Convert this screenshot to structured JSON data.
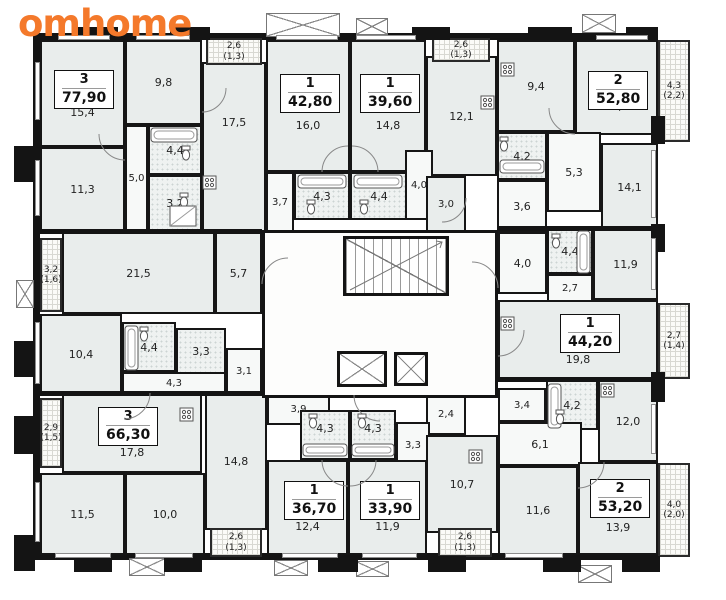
{
  "logo": {
    "text": "omhome",
    "color": "#f4792b"
  },
  "colors": {
    "wall": "#141414",
    "room_fill": "#e9edec",
    "bath_fill": "#eff2f1"
  },
  "apartments": [
    {
      "rooms_count": "3",
      "total_area": "77,90",
      "rooms": {
        "bedroom_1": "15,4",
        "bedroom_2": "11,3",
        "bedroom_3": "9,8",
        "living": "21,5",
        "kitchen": "5,7",
        "hall": "5,0",
        "bathroom": "4,4",
        "wc": "3,2"
      },
      "balcony": {
        "area": "3,2",
        "reduced": "(1,6)"
      }
    },
    {
      "rooms_count": "1",
      "total_area": "42,80",
      "rooms": {
        "living_kitchen": "17,5",
        "bedroom": "16,0",
        "bathroom": "4,3",
        "hall": "3,7"
      },
      "balcony": {
        "area": "2,6",
        "reduced": "(1,3)"
      }
    },
    {
      "rooms_count": "1",
      "total_area": "39,60",
      "rooms": {
        "bedroom": "14,8",
        "kitchen": "12,1",
        "bathroom": "4,4",
        "hall": "4,0",
        "hall_2": "3,0"
      },
      "balcony": {
        "area": "2,6",
        "reduced": "(1,3)"
      }
    },
    {
      "rooms_count": "2",
      "total_area": "52,80",
      "rooms": {
        "kitchen": "9,4",
        "bedroom_1": "14,0",
        "bedroom_2": "14,1",
        "bathroom": "4,2",
        "hall": "5,3",
        "hall_2": "3,6"
      },
      "balcony": {
        "area": "4,3",
        "reduced": "(2,2)"
      }
    },
    {
      "rooms_count": "1",
      "total_area": "44,20",
      "rooms": {
        "living_kitchen": "19,8",
        "bedroom": "11,9",
        "bathroom": "4,4",
        "hall": "4,0",
        "hall_2": "2,7"
      },
      "balcony": {
        "area": "2,7",
        "reduced": "(1,4)"
      }
    },
    {
      "rooms_count": "3",
      "total_area": "66,30",
      "rooms": {
        "living_kitchen": "17,8",
        "bedroom_1": "11,5",
        "bedroom_2": "10,0",
        "bedroom_3": "10,4",
        "bathroom": "4,4",
        "wc": "3,3",
        "hall": "4,3",
        "hall_2": "3,1"
      },
      "balcony": {
        "area": "2,9",
        "reduced": "(1,5)"
      }
    },
    {
      "rooms_count": "1",
      "total_area": "36,70",
      "rooms": {
        "bedroom": "14,8",
        "living": "12,4",
        "bathroom": "4,3",
        "hall": "3,9"
      },
      "balcony": {
        "area": "2,6",
        "reduced": "(1,3)"
      }
    },
    {
      "rooms_count": "1",
      "total_area": "33,90",
      "rooms": {
        "living": "11,9",
        "kitchen": "10,7",
        "bathroom": "4,3",
        "hall": "3,3",
        "hall_2": "2,4"
      },
      "balcony": {
        "area": "2,6",
        "reduced": "(1,3)"
      }
    },
    {
      "rooms_count": "2",
      "total_area": "53,20",
      "rooms": {
        "bedroom_1": "13,9",
        "bedroom_2": "11,6",
        "kitchen": "12,0",
        "bathroom": "4,2",
        "hall": "6,1",
        "hall_2": "3,4"
      },
      "balcony": {
        "area": "4,0",
        "reduced": "(2,0)"
      }
    }
  ]
}
